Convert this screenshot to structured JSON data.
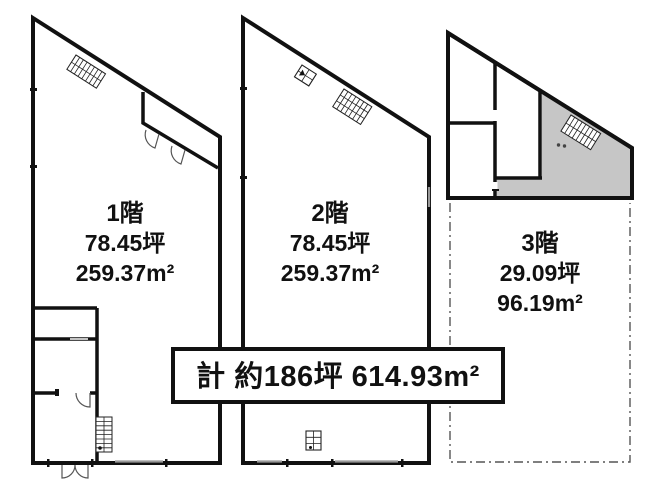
{
  "floors": [
    {
      "name": "1階",
      "tsubo": "78.45坪",
      "area": "259.37m²"
    },
    {
      "name": "2階",
      "tsubo": "78.45坪",
      "area": "259.37m²"
    },
    {
      "name": "3階",
      "tsubo": "29.09坪",
      "area": "96.19m²"
    }
  ],
  "total": {
    "label": "計 約186坪 614.93m²"
  },
  "colors": {
    "wall": "#111111",
    "floor3_shade": "#c6c6c6",
    "dashed_outline": "#555555",
    "window_mark": "#999999"
  },
  "icons": {
    "stairs_icon": "hatched stair-run rectangle",
    "elevator_icon": "small grid box",
    "door_swing_icon": "quarter-circle arc"
  }
}
